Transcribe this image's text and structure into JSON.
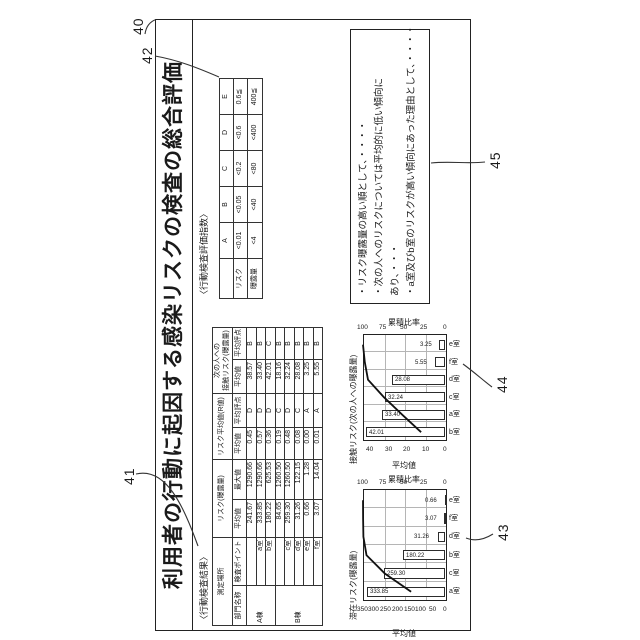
{
  "figure": {
    "title": "利用者の行動に起因する感染リスクの検査の総合評価",
    "ref_labels": {
      "outer_box": "40",
      "result_table": "41",
      "index_table": "42",
      "stay_chart": "43",
      "contact_chart": "44",
      "findings_box": "45"
    }
  },
  "result_table": {
    "caption": "〈行動検査結果〉",
    "col_groups": [
      {
        "label": "測定場所",
        "cols": [
          "部門名称",
          "検査ポイント"
        ]
      },
      {
        "label": "リスク(曝露量)",
        "cols": [
          "平均値",
          "最大値"
        ]
      },
      {
        "label": "リスク平均値(R値)",
        "cols": [
          "平均値",
          "平均評点"
        ]
      },
      {
        "label1": "次の人への",
        "label2": "接触リスク(曝露量)",
        "cols": [
          "平均値",
          "平均評点"
        ]
      }
    ],
    "rows": [
      {
        "building": "A棟",
        "span": 3,
        "point": "",
        "avg": "241.67",
        "max": "1290.66",
        "r_avg": "0.45",
        "r_grade": "D",
        "c_avg": "38.57",
        "c_grade": "B"
      },
      {
        "point": "a室",
        "avg": "333.85",
        "max": "1290.66",
        "r_avg": "0.57",
        "r_grade": "D",
        "c_avg": "33.40",
        "c_grade": "B"
      },
      {
        "point": "b室",
        "avg": "180.22",
        "max": "625.53",
        "r_avg": "0.36",
        "r_grade": "D",
        "c_avg": "42.01",
        "c_grade": "C"
      },
      {
        "building": "B棟",
        "span": 5,
        "point": "",
        "avg": "84.65",
        "max": "1260.50",
        "r_avg": "0.19",
        "r_grade": "C",
        "c_avg": "18.16",
        "c_grade": "B"
      },
      {
        "point": "c室",
        "avg": "259.30",
        "max": "1260.50",
        "r_avg": "0.48",
        "r_grade": "D",
        "c_avg": "32.24",
        "c_grade": "B"
      },
      {
        "point": "d室",
        "avg": "31.26",
        "max": "122.15",
        "r_avg": "0.08",
        "r_grade": "C",
        "c_avg": "28.08",
        "c_grade": "B"
      },
      {
        "point": "e室",
        "avg": "0.66",
        "max": "1.28",
        "r_avg": "0.00",
        "r_grade": "A",
        "c_avg": "3.25",
        "c_grade": "B"
      },
      {
        "point": "f室",
        "avg": "3.07",
        "max": "14.04",
        "r_avg": "0.01",
        "r_grade": "A",
        "c_avg": "5.55",
        "c_grade": "B"
      }
    ]
  },
  "index_table": {
    "caption": "〈行動検査評価指数〉",
    "grades": [
      "A",
      "B",
      "C",
      "D",
      "E"
    ],
    "rows": [
      {
        "label": "リスク",
        "values": [
          "<0.01",
          "<0.05",
          "<0.2",
          "<0.6",
          "0.6≦"
        ]
      },
      {
        "label": "曝露量",
        "values": [
          "<4",
          "<40",
          "<80",
          "<400",
          "400≦"
        ]
      }
    ]
  },
  "findings": {
    "lines": [
      "・リスク曝露量の高い順として、・・・・",
      "・次の人へのリスクについては平均的に低い傾向に",
      "あり、・・・",
      "・a室及びb室のリスクが高い傾向にあった理由として、・・・・"
    ]
  },
  "chart_data": [
    {
      "id": "stay",
      "type": "bar",
      "title": "滞在リスク(曝露量)",
      "categories": [
        "a室",
        "c室",
        "b室",
        "d室",
        "f室",
        "e室"
      ],
      "values": [
        333.85,
        259.3,
        180.22,
        31.26,
        3.07,
        0.66
      ],
      "value_labels": [
        "333.85",
        "259.30",
        "180.22",
        "31.26",
        "3.07",
        "0.66"
      ],
      "cumulative_pct": [
        41.3,
        73.4,
        95.7,
        99.5,
        99.9,
        100
      ],
      "ylabel": "平均値",
      "y2label": "累積比率",
      "yticks": [
        0,
        50,
        100,
        150,
        200,
        250,
        300,
        350
      ],
      "ymax": 350,
      "y2ticks": [
        0,
        25,
        50,
        75,
        100
      ],
      "y2max": 100,
      "grid": true,
      "line_series": "累積比率"
    },
    {
      "id": "contact",
      "type": "bar",
      "title": "接触リスク(次の人への曝露量)",
      "categories": [
        "b室",
        "a室",
        "c室",
        "d室",
        "f室",
        "e室"
      ],
      "values": [
        42.01,
        33.4,
        32.24,
        28.08,
        5.55,
        3.25
      ],
      "value_labels": [
        "42.01",
        "33.40",
        "32.24",
        "28.08",
        "5.55",
        "3.25"
      ],
      "cumulative_pct": [
        29.1,
        52.2,
        74.5,
        93.9,
        97.8,
        100
      ],
      "ylabel": "平均値",
      "y2label": "累積比率",
      "yticks": [
        0,
        10,
        20,
        30,
        40
      ],
      "ymax": 43.75,
      "y2ticks": [
        0,
        25,
        50,
        75,
        100
      ],
      "y2max": 100,
      "grid": true,
      "line_series": "累積比率"
    }
  ]
}
